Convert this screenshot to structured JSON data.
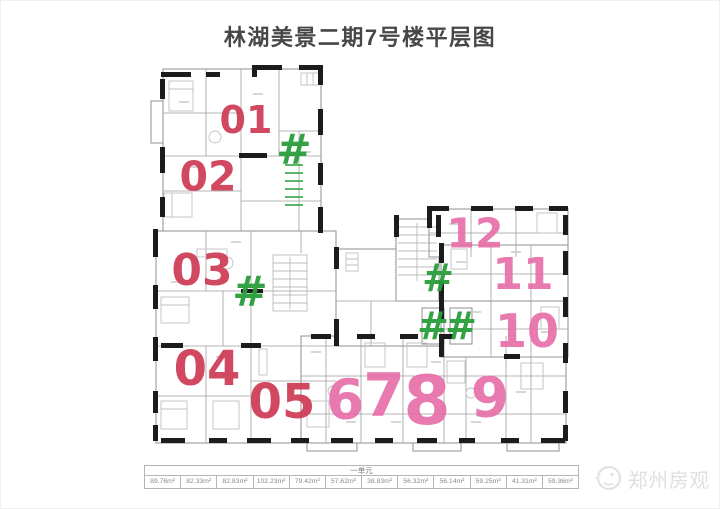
{
  "title": "林湖美景二期7号楼平层图",
  "plan": {
    "units": [
      {
        "id": "unit-01",
        "label": "01"
      },
      {
        "id": "unit-02",
        "label": "02"
      },
      {
        "id": "unit-03",
        "label": "03"
      },
      {
        "id": "unit-04",
        "label": "04"
      },
      {
        "id": "unit-05",
        "label": "05"
      },
      {
        "id": "unit-6",
        "label": "6"
      },
      {
        "id": "unit-7",
        "label": "7"
      },
      {
        "id": "unit-8",
        "label": "8"
      },
      {
        "id": "unit-9",
        "label": "9"
      },
      {
        "id": "unit-10",
        "label": "10"
      },
      {
        "id": "unit-11",
        "label": "11"
      },
      {
        "id": "unit-12",
        "label": "12"
      }
    ],
    "hash_marks": [
      "#",
      "#",
      "#",
      "#",
      "#"
    ]
  },
  "area_table": {
    "header": "一单元",
    "areas": [
      "89.76m²",
      "82.33m²",
      "82.83m²",
      "102.23m²",
      "79.42m²",
      "57.62m²",
      "38.83m²",
      "56.32m²",
      "56.14m²",
      "59.25m²",
      "41.31m²",
      "59.36m²"
    ]
  },
  "watermark": {
    "text": "郑州房观"
  },
  "colors": {
    "unit_red": "#ce3a53",
    "unit_pink": "#e76fa9",
    "hash_green": "#289e3b",
    "title_gray": "#474747",
    "wall_dark": "#1c1c1c",
    "line_gray": "#9a9a9a",
    "table_border": "#b5b5b5",
    "table_text": "#8a8a8a",
    "watermark_gray": "#dedede"
  }
}
